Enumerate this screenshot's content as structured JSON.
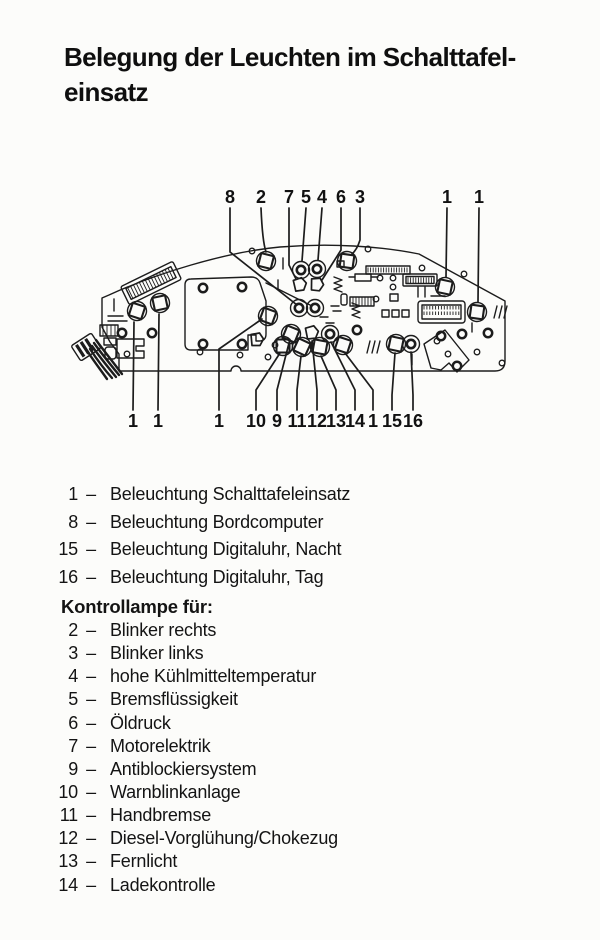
{
  "page": {
    "title_line1": "Belegung der Leuchten im Schalttafel-",
    "title_line2": "einsatz"
  },
  "figure": {
    "top_callouts": [
      "8",
      "2",
      "7",
      "5",
      "4",
      "6",
      "3",
      "1",
      "1"
    ],
    "bottom_callouts": [
      "1",
      "1",
      "1",
      "10",
      "9",
      "11",
      "12",
      "13",
      "14",
      "1",
      "15",
      "16"
    ]
  },
  "legend": {
    "separator": "–",
    "lighting_items": [
      {
        "num": "1",
        "label": "Beleuchtung Schalttafeleinsatz"
      },
      {
        "num": "8",
        "label": "Beleuchtung Bordcomputer"
      },
      {
        "num": "15",
        "label": "Beleuchtung Digitaluhr, Nacht"
      },
      {
        "num": "16",
        "label": "Beleuchtung Digitaluhr, Tag"
      }
    ],
    "section_heading": "Kontrollampe für:",
    "indicator_items": [
      {
        "num": "2",
        "label": "Blinker rechts"
      },
      {
        "num": "3",
        "label": "Blinker links"
      },
      {
        "num": "4",
        "label": "hohe Kühlmitteltemperatur"
      },
      {
        "num": "5",
        "label": "Bremsflüssigkeit"
      },
      {
        "num": "6",
        "label": "Öldruck"
      },
      {
        "num": "7",
        "label": "Motorelektrik"
      },
      {
        "num": "9",
        "label": "Antiblockiersystem"
      },
      {
        "num": "10",
        "label": "Warnblinkanlage"
      },
      {
        "num": "11",
        "label": "Handbremse"
      },
      {
        "num": "12",
        "label": "Diesel-Vorglühung/Chokezug"
      },
      {
        "num": "13",
        "label": "Fernlicht"
      },
      {
        "num": "14",
        "label": "Ladekontrolle"
      }
    ]
  },
  "colors": {
    "ink": "#1c1c1c",
    "paper": "#fcfcfa"
  }
}
